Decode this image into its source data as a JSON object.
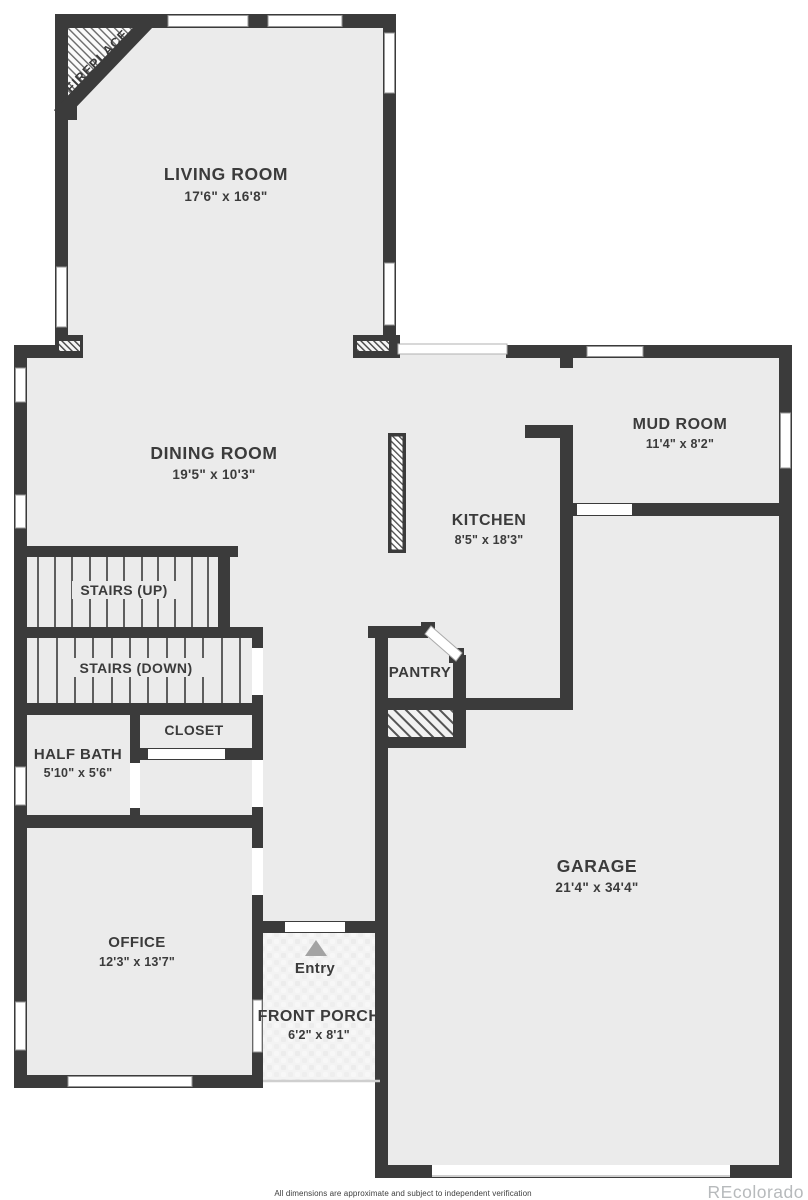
{
  "rooms": {
    "living_room": {
      "name": "LIVING ROOM",
      "dims": "17'6\" x 16'8\""
    },
    "dining_room": {
      "name": "DINING ROOM",
      "dims": "19'5\" x 10'3\""
    },
    "mud_room": {
      "name": "MUD ROOM",
      "dims": "11'4\" x 8'2\""
    },
    "kitchen": {
      "name": "KITCHEN",
      "dims": "8'5\" x 18'3\""
    },
    "stairs_up": {
      "name": "STAIRS (UP)"
    },
    "stairs_down": {
      "name": "STAIRS (DOWN)"
    },
    "closet": {
      "name": "CLOSET"
    },
    "half_bath": {
      "name": "HALF BATH",
      "dims": "5'10\" x 5'6\""
    },
    "pantry": {
      "name": "PANTRY"
    },
    "office": {
      "name": "OFFICE",
      "dims": "12'3\" x 13'7\""
    },
    "entry": {
      "name": "Entry"
    },
    "front_porch": {
      "name": "FRONT PORCH",
      "dims": "6'2\" x 8'1\""
    },
    "garage": {
      "name": "GARAGE",
      "dims": "21'4\" x 34'4\""
    },
    "fireplace": {
      "name": "FIREPLACE"
    }
  },
  "footer": {
    "disclaimer": "All dimensions are approximate and subject to independent verification"
  },
  "watermark": {
    "text": "REcolorado"
  },
  "colors": {
    "wall": "#3b3b3b",
    "floor": "#ebebeb",
    "porch_floor": "#f3f3f3",
    "entry_arrow": "#a3a3a3",
    "watermark": "#b7babc"
  }
}
